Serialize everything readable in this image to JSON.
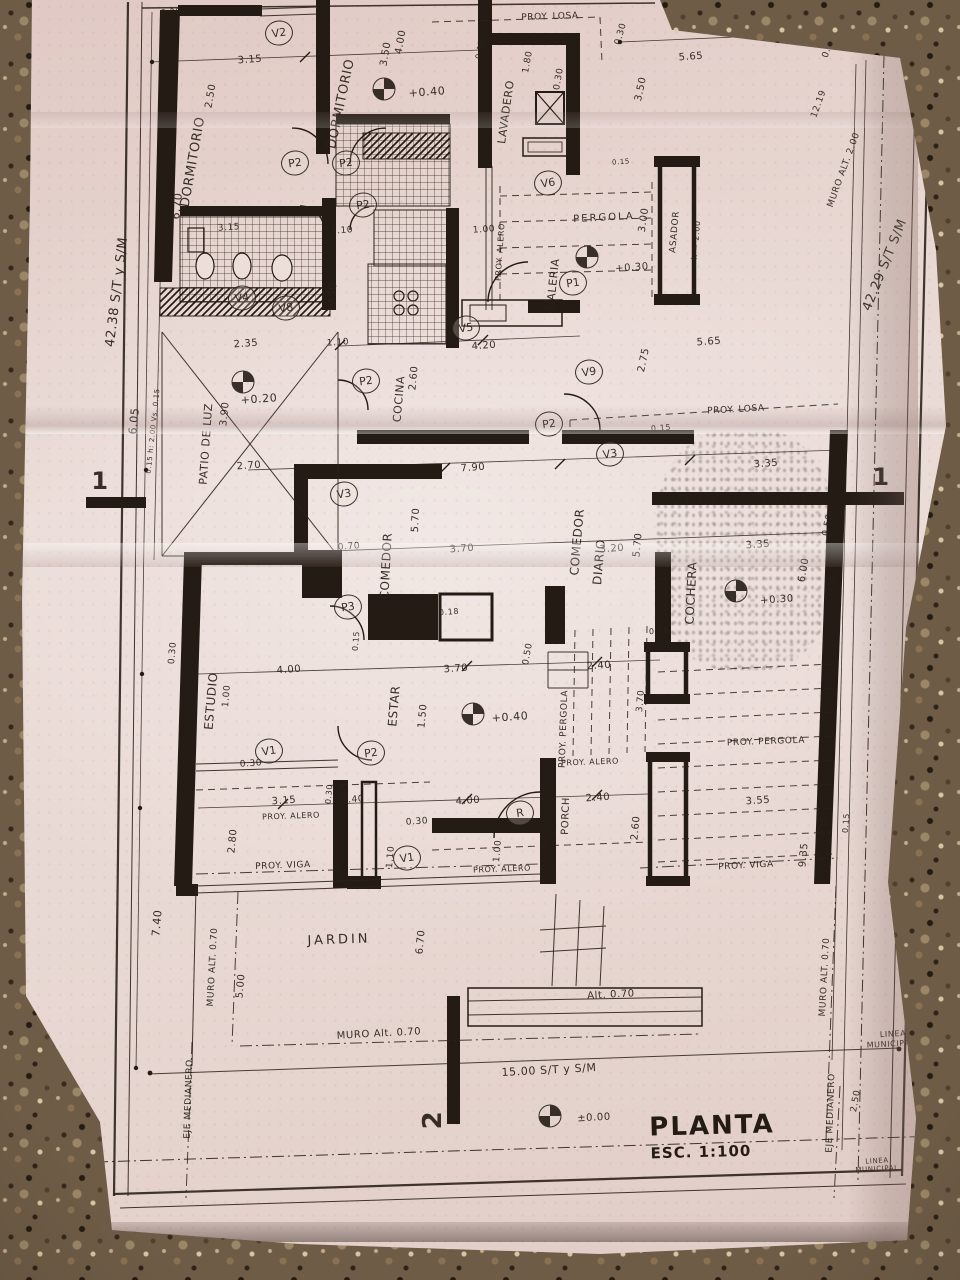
{
  "title_block": {
    "title": "PLANTA",
    "scale": "ESC. 1:100"
  },
  "boundary_dims": {
    "left_side": "42.38 S/T y S/M",
    "right_side": "42.29 S/T S/M",
    "frontage": "15.00 S/T y S/M"
  },
  "plan": {
    "labels": [
      {
        "t": "DORMITORIO",
        "n": "room-label-dormitorio-1",
        "x": 193,
        "y": 162,
        "r": -80,
        "s": 13
      },
      {
        "t": "2.50",
        "x": 211,
        "y": 96,
        "r": -80,
        "s": 10
      },
      {
        "t": "3.15",
        "x": 250,
        "y": 60,
        "r": -4,
        "s": 10
      },
      {
        "t": "0.30",
        "x": 171,
        "y": 12,
        "r": -4,
        "s": 8
      },
      {
        "t": "DORMITORIO",
        "n": "room-label-dormitorio-2",
        "x": 341,
        "y": 104,
        "r": -78,
        "s": 13
      },
      {
        "t": "3.50",
        "x": 386,
        "y": 54,
        "r": -80,
        "s": 10
      },
      {
        "t": "4.00",
        "x": 401,
        "y": 42,
        "r": -80,
        "s": 10
      },
      {
        "t": "+0.40",
        "x": 427,
        "y": 92,
        "r": -4,
        "s": 11
      },
      {
        "t": "PROY. LOSA",
        "x": 550,
        "y": 17,
        "r": -2,
        "s": 9
      },
      {
        "t": "LAVADERO",
        "n": "room-label-lavadero",
        "x": 506,
        "y": 112,
        "r": -82,
        "s": 11
      },
      {
        "t": "1.80",
        "x": 528,
        "y": 62,
        "r": -80,
        "s": 9
      },
      {
        "t": "0.30",
        "x": 559,
        "y": 79,
        "r": -80,
        "s": 9
      },
      {
        "t": "0.15",
        "x": 480,
        "y": 49,
        "r": -80,
        "s": 8
      },
      {
        "t": "0.30",
        "x": 621,
        "y": 34,
        "r": -74,
        "s": 9
      },
      {
        "t": "5.65",
        "x": 691,
        "y": 57,
        "r": -4,
        "s": 10
      },
      {
        "t": "3.50",
        "x": 641,
        "y": 89,
        "r": -78,
        "s": 10
      },
      {
        "t": "0.50",
        "x": 829,
        "y": 47,
        "r": -72,
        "s": 9
      },
      {
        "t": "12.19",
        "x": 819,
        "y": 104,
        "r": -70,
        "s": 9
      },
      {
        "t": "MURO ALT. 2.00",
        "x": 844,
        "y": 170,
        "r": -70,
        "s": 9
      },
      {
        "t": "42.29 S/T S/M",
        "n": "boundary-right",
        "x": 885,
        "y": 265,
        "r": -68,
        "s": 13
      },
      {
        "t": "42.38 S/T y S/M",
        "n": "boundary-left",
        "x": 117,
        "y": 292,
        "r": -83,
        "s": 13
      },
      {
        "t": "6.70",
        "x": 177,
        "y": 206,
        "r": -83,
        "s": 11
      },
      {
        "t": "PERGOLA",
        "n": "room-label-pergola",
        "x": 604,
        "y": 218,
        "r": -3,
        "s": 10,
        "ls": 2
      },
      {
        "t": "GALERIA",
        "n": "room-label-galeria",
        "x": 553,
        "y": 284,
        "r": -84,
        "s": 11
      },
      {
        "t": "PROY. ALERO",
        "x": 500,
        "y": 252,
        "r": -86,
        "s": 8
      },
      {
        "t": "ASADOR",
        "n": "room-label-asador",
        "x": 675,
        "y": 232,
        "r": -85,
        "s": 9
      },
      {
        "t": "h = 2.00",
        "x": 696,
        "y": 240,
        "r": -85,
        "s": 8
      },
      {
        "t": "3.00",
        "x": 644,
        "y": 220,
        "r": -82,
        "s": 10
      },
      {
        "t": "1.00",
        "x": 484,
        "y": 230,
        "r": -4,
        "s": 9
      },
      {
        "t": "+0.30",
        "x": 632,
        "y": 268,
        "r": -4,
        "s": 10
      },
      {
        "t": "0.15",
        "x": 621,
        "y": 162,
        "r": -4,
        "s": 7
      },
      {
        "t": "PASO",
        "n": "room-label-paso",
        "x": 333,
        "y": 296,
        "r": -86,
        "s": 10
      },
      {
        "t": "1.10",
        "x": 342,
        "y": 231,
        "r": -4,
        "s": 9
      },
      {
        "t": "3.15",
        "x": 229,
        "y": 228,
        "r": -4,
        "s": 9
      },
      {
        "t": "2.35",
        "x": 246,
        "y": 344,
        "r": -4,
        "s": 10
      },
      {
        "t": "PATIO DE LUZ",
        "n": "room-label-patio-de-luz",
        "x": 206,
        "y": 444,
        "r": -86,
        "s": 11
      },
      {
        "t": "3.90",
        "x": 225,
        "y": 414,
        "r": -84,
        "s": 10
      },
      {
        "t": "6.05",
        "x": 134,
        "y": 421,
        "r": -84,
        "s": 11
      },
      {
        "t": "0.15 h: 2.00 Vs. 0.15",
        "x": 153,
        "y": 431,
        "r": -84,
        "s": 7
      },
      {
        "t": "+0.20",
        "x": 259,
        "y": 399,
        "r": -4,
        "s": 11
      },
      {
        "t": "2.70",
        "x": 249,
        "y": 466,
        "r": -4,
        "s": 10
      },
      {
        "t": "1.10",
        "x": 338,
        "y": 343,
        "r": -4,
        "s": 9
      },
      {
        "t": "COCINA",
        "n": "room-label-cocina",
        "x": 399,
        "y": 399,
        "r": -85,
        "s": 11
      },
      {
        "t": "2.60",
        "x": 414,
        "y": 378,
        "r": -85,
        "s": 10
      },
      {
        "t": "4.20",
        "x": 484,
        "y": 346,
        "r": -4,
        "s": 10
      },
      {
        "t": "7.90",
        "x": 473,
        "y": 468,
        "r": -4,
        "s": 10
      },
      {
        "t": "PROY. LOSA",
        "x": 736,
        "y": 410,
        "r": -3,
        "s": 9
      },
      {
        "t": "0.15",
        "x": 661,
        "y": 428,
        "r": -4,
        "s": 8
      },
      {
        "t": "3.35",
        "x": 766,
        "y": 464,
        "r": -4,
        "s": 10
      },
      {
        "t": "2.75",
        "x": 644,
        "y": 360,
        "r": -78,
        "s": 10
      },
      {
        "t": "5.65",
        "x": 709,
        "y": 342,
        "r": -4,
        "s": 10
      },
      {
        "t": "COMEDOR",
        "n": "room-label-comedor",
        "x": 386,
        "y": 566,
        "r": -87,
        "s": 12
      },
      {
        "t": "5.70",
        "x": 416,
        "y": 520,
        "r": -87,
        "s": 10
      },
      {
        "t": "0.70",
        "x": 349,
        "y": 547,
        "r": -4,
        "s": 9
      },
      {
        "t": "3.70",
        "x": 462,
        "y": 549,
        "r": -4,
        "s": 10
      },
      {
        "t": "0.18",
        "x": 449,
        "y": 612,
        "r": -4,
        "s": 8
      },
      {
        "t": "COMEDOR",
        "n": "room-label-comedor-diario",
        "x": 577,
        "y": 542,
        "r": -85,
        "s": 12
      },
      {
        "t": "DIARIO",
        "x": 599,
        "y": 562,
        "r": -85,
        "s": 12
      },
      {
        "t": "5.70",
        "x": 638,
        "y": 545,
        "r": -85,
        "s": 10
      },
      {
        "t": "3.20",
        "x": 612,
        "y": 549,
        "r": -4,
        "s": 10
      },
      {
        "t": "COCHERA",
        "n": "room-label-cochera",
        "x": 691,
        "y": 593,
        "r": -87,
        "s": 12
      },
      {
        "t": "3.35",
        "x": 758,
        "y": 545,
        "r": -4,
        "s": 10
      },
      {
        "t": "6.00",
        "x": 804,
        "y": 570,
        "r": -80,
        "s": 10
      },
      {
        "t": "0.50",
        "x": 828,
        "y": 525,
        "r": -78,
        "s": 9
      },
      {
        "t": "+0.30",
        "x": 777,
        "y": 600,
        "r": -4,
        "s": 10
      },
      {
        "t": "ESTUDIO",
        "n": "room-label-estudio",
        "x": 211,
        "y": 701,
        "r": -85,
        "s": 12
      },
      {
        "t": "4.00",
        "x": 289,
        "y": 670,
        "r": -4,
        "s": 10
      },
      {
        "t": "1.00",
        "x": 227,
        "y": 696,
        "r": -85,
        "s": 9
      },
      {
        "t": "0.30",
        "x": 173,
        "y": 653,
        "r": -85,
        "s": 9
      },
      {
        "t": "ESTAR",
        "n": "room-label-estar",
        "x": 394,
        "y": 706,
        "r": -85,
        "s": 12
      },
      {
        "t": "1.50",
        "x": 423,
        "y": 716,
        "r": -85,
        "s": 10
      },
      {
        "t": "0.15",
        "x": 356,
        "y": 641,
        "r": -85,
        "s": 8
      },
      {
        "t": "+0.40",
        "x": 510,
        "y": 717,
        "r": -4,
        "s": 11
      },
      {
        "t": "3.70",
        "x": 456,
        "y": 669,
        "r": -4,
        "s": 10
      },
      {
        "t": "0.50",
        "x": 528,
        "y": 654,
        "r": -80,
        "s": 9
      },
      {
        "t": "2.40",
        "x": 599,
        "y": 666,
        "r": -4,
        "s": 10
      },
      {
        "t": "0.30",
        "x": 659,
        "y": 631,
        "r": -4,
        "s": 8
      },
      {
        "t": "PROY. PERGOLA",
        "x": 564,
        "y": 729,
        "r": -88,
        "s": 9
      },
      {
        "t": "3.70",
        "x": 641,
        "y": 701,
        "r": -85,
        "s": 9
      },
      {
        "t": "PROY. ALERO",
        "x": 590,
        "y": 762,
        "r": -2,
        "s": 8
      },
      {
        "t": "2.40",
        "x": 598,
        "y": 798,
        "r": -4,
        "s": 10
      },
      {
        "t": "PORCH",
        "n": "room-label-porch",
        "x": 566,
        "y": 816,
        "r": -88,
        "s": 10
      },
      {
        "t": "2.60",
        "x": 636,
        "y": 828,
        "r": -85,
        "s": 10
      },
      {
        "t": "4.00",
        "x": 468,
        "y": 801,
        "r": -4,
        "s": 10
      },
      {
        "t": "1.00",
        "x": 498,
        "y": 851,
        "r": -85,
        "s": 9
      },
      {
        "t": "PROY. ALERO",
        "x": 502,
        "y": 869,
        "r": -2,
        "s": 8
      },
      {
        "t": "0.30",
        "x": 251,
        "y": 764,
        "r": -4,
        "s": 9
      },
      {
        "t": "3.15",
        "x": 284,
        "y": 801,
        "r": -4,
        "s": 10
      },
      {
        "t": "PROY. ALERO",
        "x": 291,
        "y": 816,
        "r": -2,
        "s": 8
      },
      {
        "t": "0.30",
        "x": 329,
        "y": 794,
        "r": -85,
        "s": 8
      },
      {
        "t": "0.40",
        "x": 353,
        "y": 800,
        "r": -4,
        "s": 9
      },
      {
        "t": "2.80",
        "x": 233,
        "y": 841,
        "r": -85,
        "s": 10
      },
      {
        "t": "PROY. VIGA",
        "x": 283,
        "y": 866,
        "r": -2,
        "s": 9
      },
      {
        "t": "0.30",
        "x": 417,
        "y": 822,
        "r": -4,
        "s": 9
      },
      {
        "t": "1.10",
        "x": 391,
        "y": 857,
        "r": -85,
        "s": 9
      },
      {
        "t": "7.40",
        "x": 157,
        "y": 923,
        "r": -85,
        "s": 11
      },
      {
        "t": "MURO ALT. 0.70",
        "x": 213,
        "y": 967,
        "r": -87,
        "s": 9
      },
      {
        "t": "5.00",
        "x": 241,
        "y": 986,
        "r": -85,
        "s": 10
      },
      {
        "t": "JARDIN",
        "n": "room-label-jardin",
        "x": 339,
        "y": 940,
        "r": -2,
        "s": 13,
        "ls": 3
      },
      {
        "t": "6.70",
        "x": 421,
        "y": 942,
        "r": -85,
        "s": 10
      },
      {
        "t": "MURO Alt. 0.70",
        "x": 379,
        "y": 1034,
        "r": -3,
        "s": 10
      },
      {
        "t": "Alt. 0.70",
        "x": 611,
        "y": 995,
        "r": -3,
        "s": 10
      },
      {
        "t": "3.55",
        "x": 758,
        "y": 801,
        "r": -4,
        "s": 10
      },
      {
        "t": "PROY. PERGOLA",
        "x": 766,
        "y": 742,
        "r": -2,
        "s": 9
      },
      {
        "t": "PROY. VIGA",
        "x": 746,
        "y": 866,
        "r": -3,
        "s": 9
      },
      {
        "t": "9.35",
        "x": 804,
        "y": 855,
        "r": -85,
        "s": 10
      },
      {
        "t": "0.15",
        "x": 823,
        "y": 826,
        "r": -85,
        "s": 8
      },
      {
        "t": "0.15",
        "x": 846,
        "y": 823,
        "r": -85,
        "s": 8
      },
      {
        "t": "MURO ALT. 0.70",
        "x": 825,
        "y": 977,
        "r": -87,
        "s": 9
      },
      {
        "t": "LINEA",
        "x": 893,
        "y": 1034,
        "r": -3,
        "s": 8
      },
      {
        "t": "MUNICIPAL",
        "x": 891,
        "y": 1044,
        "r": -3,
        "s": 8
      },
      {
        "t": "15.00  S/T y S/M",
        "n": "boundary-frontage",
        "x": 549,
        "y": 1070,
        "r": -3,
        "s": 11
      },
      {
        "t": "±0.00",
        "x": 594,
        "y": 1118,
        "r": -3,
        "s": 10
      },
      {
        "t": "EJE MEDIANERO",
        "x": 189,
        "y": 1099,
        "r": -88,
        "s": 9
      },
      {
        "t": "EJE MEDIANERO",
        "x": 831,
        "y": 1113,
        "r": -88,
        "s": 9
      },
      {
        "t": "2.50",
        "x": 856,
        "y": 1101,
        "r": -80,
        "s": 9
      },
      {
        "t": "LINEA",
        "x": 877,
        "y": 1161,
        "r": -3,
        "s": 7
      },
      {
        "t": "MUNICIPAL",
        "x": 877,
        "y": 1169,
        "r": -3,
        "s": 7
      },
      {
        "t": "1",
        "n": "section-mark-1-left",
        "x": 100,
        "y": 481,
        "r": 0,
        "s": 24,
        "b": 1
      },
      {
        "t": "1",
        "n": "section-mark-1-right",
        "x": 881,
        "y": 477,
        "r": 0,
        "s": 24,
        "b": 1
      },
      {
        "t": "2",
        "n": "section-mark-2",
        "x": 433,
        "y": 1120,
        "r": -90,
        "s": 26,
        "b": 1
      }
    ],
    "tags": [
      {
        "t": "V2",
        "x": 279,
        "y": 33
      },
      {
        "t": "P2",
        "x": 295,
        "y": 163
      },
      {
        "t": "P2",
        "x": 346,
        "y": 163
      },
      {
        "t": "P2",
        "x": 363,
        "y": 205
      },
      {
        "t": "V4",
        "x": 242,
        "y": 298
      },
      {
        "t": "V8",
        "x": 286,
        "y": 308
      },
      {
        "t": "V5",
        "x": 466,
        "y": 328
      },
      {
        "t": "P2",
        "x": 366,
        "y": 381
      },
      {
        "t": "V9",
        "x": 589,
        "y": 372
      },
      {
        "t": "P2",
        "x": 549,
        "y": 424
      },
      {
        "t": "V3",
        "x": 610,
        "y": 454
      },
      {
        "t": "V6",
        "x": 548,
        "y": 183
      },
      {
        "t": "P1",
        "x": 573,
        "y": 283
      },
      {
        "t": "V3",
        "x": 344,
        "y": 494
      },
      {
        "t": "P3",
        "x": 348,
        "y": 607
      },
      {
        "t": "V1",
        "x": 269,
        "y": 751
      },
      {
        "t": "P2",
        "x": 371,
        "y": 753
      },
      {
        "t": "R",
        "x": 520,
        "y": 813
      },
      {
        "t": "V1",
        "x": 407,
        "y": 858
      }
    ],
    "levels": [
      {
        "x": 384,
        "y": 89
      },
      {
        "x": 243,
        "y": 382
      },
      {
        "x": 587,
        "y": 257
      },
      {
        "x": 736,
        "y": 591
      },
      {
        "x": 473,
        "y": 714
      },
      {
        "x": 550,
        "y": 1116
      }
    ]
  }
}
